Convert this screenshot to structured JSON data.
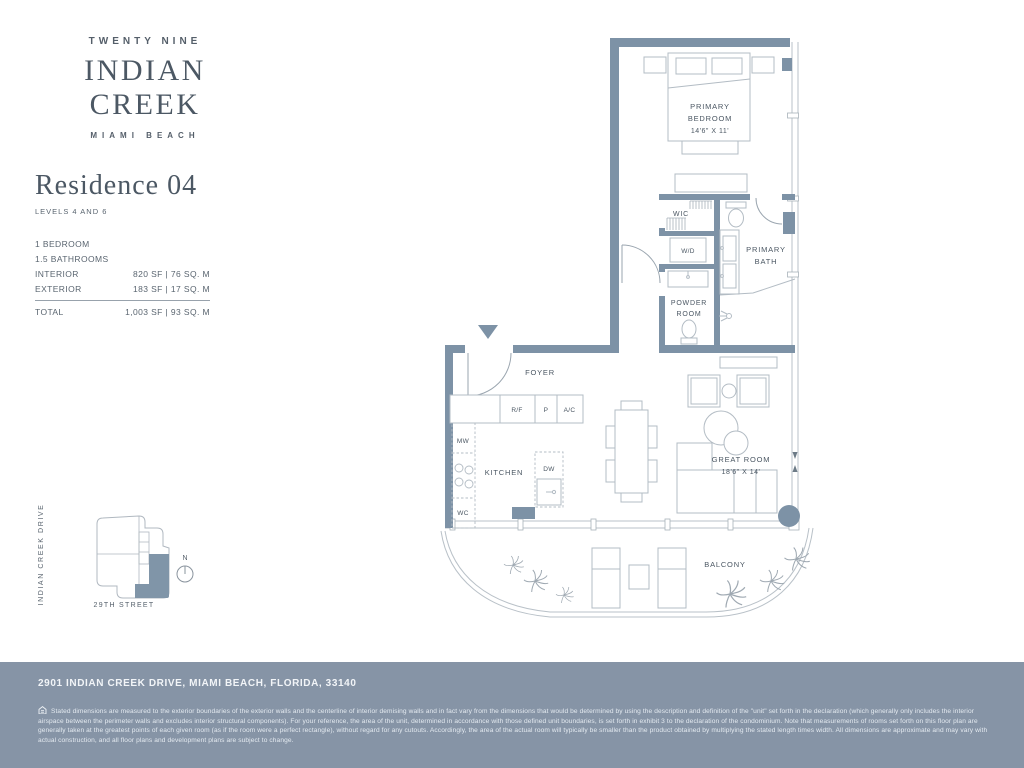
{
  "brand": {
    "line1": "TWENTY NINE",
    "line2": "INDIAN CREEK",
    "line3": "MIAMI BEACH"
  },
  "residence": {
    "title": "Residence 04",
    "levels": "LEVELS 4 AND 6",
    "bedrooms": "1 BEDROOM",
    "bathrooms": "1.5 BATHROOMS",
    "interior": {
      "label": "INTERIOR",
      "value": "820 SF  |  76 SQ. M"
    },
    "exterior": {
      "label": "EXTERIOR",
      "value": "183 SF  |  17 SQ. M"
    },
    "total": {
      "label": "TOTAL",
      "value": "1,003 SF  |  93 SQ. M"
    }
  },
  "plan": {
    "labels": {
      "primary_bedroom_1": "PRIMARY",
      "primary_bedroom_2": "BEDROOM",
      "primary_bedroom_dims": "14'6\" X 11'",
      "wic": "WIC",
      "wd": "W/D",
      "primary_bath_1": "PRIMARY",
      "primary_bath_2": "BATH",
      "powder_1": "POWDER",
      "powder_2": "ROOM",
      "foyer": "FOYER",
      "kitchen": "KITCHEN",
      "great_room": "GREAT ROOM",
      "great_room_dims": "18'6\" X 14'",
      "balcony": "BALCONY",
      "rf": "R/F",
      "pantry": "P",
      "ac": "A/C",
      "mw": "MW",
      "wc": "WC",
      "dw": "DW"
    }
  },
  "keyplan": {
    "vertical_street": "INDIAN CREEK DRIVE",
    "horizontal_street": "29TH STREET",
    "compass": "N"
  },
  "footer": {
    "address": "2901 INDIAN CREEK DRIVE, MIAMI BEACH, FLORIDA, 33140",
    "disclaimer": "Stated dimensions are measured to the exterior boundaries of the exterior walls and the centerline of interior demising walls and in fact vary from the dimensions that would be determined by using the description and definition of the \"unit\" set forth in the declaration (which generally only includes the interior airspace between the perimeter walls and excludes interior structural components). For your reference, the area of the unit, determined in accordance with those defined unit boundaries, is set forth in exhibit 3 to the declaration of the condominium. Note that measurements of rooms set forth on this floor plan are generally taken at the greatest points of each given room (as if the room were a perfect rectangle), without regard for any cutouts. Accordingly, the area of the actual room will typically be smaller than the product obtained by multiplying the stated length times width. All dimensions are approximate and may vary with actual construction, and all floor plans and development plans are subject to change."
  },
  "colors": {
    "wall": "#7d92a6",
    "footer_bg": "#8694a6",
    "heading_text": "#4c5864",
    "body_text": "#5a6570",
    "furniture_line": "#b3bcc4"
  }
}
